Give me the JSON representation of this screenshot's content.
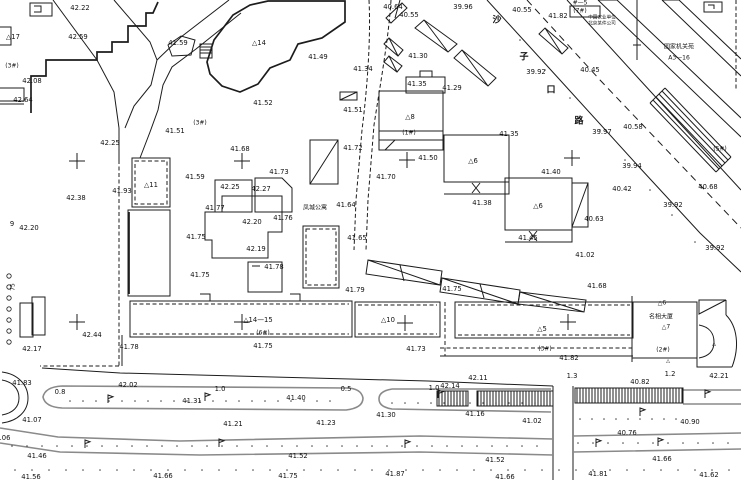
{
  "map": {
    "type": "cadastral-survey-plan",
    "background": "#ffffff",
    "ink_color": "#1c1c1c",
    "curb_color": "#8a8a8a",
    "street_name": "沙子口路",
    "compound_names": [
      "凤城公寓",
      "名相大厦",
      "国家机关苑",
      "中国农业单位",
      "北京某件公司"
    ],
    "street_chars": [
      {
        "x": 497,
        "y": 20,
        "t": "沙"
      },
      {
        "x": 524,
        "y": 57,
        "t": "子"
      },
      {
        "x": 551,
        "y": 90,
        "t": "口"
      },
      {
        "x": 579,
        "y": 121,
        "t": "路"
      }
    ],
    "labels": [
      {
        "x": 80,
        "y": 8,
        "t": "42.22"
      },
      {
        "x": 78,
        "y": 37,
        "t": "42.59"
      },
      {
        "x": 13,
        "y": 37,
        "t": "△17"
      },
      {
        "x": 12,
        "y": 66,
        "t": "(3#)",
        "fs": 6
      },
      {
        "x": 32,
        "y": 81,
        "t": "42.08"
      },
      {
        "x": 23,
        "y": 100,
        "t": "42.64"
      },
      {
        "x": 178,
        "y": 43,
        "t": "41.59"
      },
      {
        "x": 259,
        "y": 43,
        "t": "△14"
      },
      {
        "x": 263,
        "y": 103,
        "t": "41.52"
      },
      {
        "x": 200,
        "y": 123,
        "t": "(3#)",
        "fs": 6
      },
      {
        "x": 175,
        "y": 131,
        "t": "41.51"
      },
      {
        "x": 318,
        "y": 57,
        "t": "41.49"
      },
      {
        "x": 353,
        "y": 110,
        "t": "41.51"
      },
      {
        "x": 110,
        "y": 143,
        "t": "42.25"
      },
      {
        "x": 76,
        "y": 198,
        "t": "42.38"
      },
      {
        "x": 122,
        "y": 191,
        "t": "41.93"
      },
      {
        "x": 151,
        "y": 185,
        "t": "△11"
      },
      {
        "x": 12,
        "y": 224,
        "t": "9"
      },
      {
        "x": 29,
        "y": 228,
        "t": "42.20"
      },
      {
        "x": 13,
        "y": 287,
        "t": "75",
        "rot": -90,
        "fs": 6
      },
      {
        "x": 240,
        "y": 149,
        "t": "41.68"
      },
      {
        "x": 279,
        "y": 172,
        "t": "41.73"
      },
      {
        "x": 195,
        "y": 177,
        "t": "41.59"
      },
      {
        "x": 230,
        "y": 187,
        "t": "42.25"
      },
      {
        "x": 261,
        "y": 189,
        "t": "42.27"
      },
      {
        "x": 215,
        "y": 208,
        "t": "41.77"
      },
      {
        "x": 252,
        "y": 222,
        "t": "42.20"
      },
      {
        "x": 283,
        "y": 218,
        "t": "41.76"
      },
      {
        "x": 196,
        "y": 237,
        "t": "41.75"
      },
      {
        "x": 256,
        "y": 249,
        "t": "42.19"
      },
      {
        "x": 274,
        "y": 267,
        "t": "41.78"
      },
      {
        "x": 200,
        "y": 275,
        "t": "41.75"
      },
      {
        "x": 315,
        "y": 208,
        "t": "凤城公寓",
        "fs": 6
      },
      {
        "x": 346,
        "y": 205,
        "t": "41.64"
      },
      {
        "x": 357,
        "y": 238,
        "t": "41.65"
      },
      {
        "x": 353,
        "y": 148,
        "t": "41.72"
      },
      {
        "x": 393,
        "y": 7,
        "t": "40.64"
      },
      {
        "x": 409,
        "y": 15,
        "t": "40.55"
      },
      {
        "x": 463,
        "y": 7,
        "t": "39.96"
      },
      {
        "x": 418,
        "y": 56,
        "t": "41.30"
      },
      {
        "x": 363,
        "y": 69,
        "t": "41.34"
      },
      {
        "x": 417,
        "y": 84,
        "t": "41.35"
      },
      {
        "x": 452,
        "y": 88,
        "t": "41.29"
      },
      {
        "x": 410,
        "y": 117,
        "t": "△8"
      },
      {
        "x": 409,
        "y": 133,
        "t": "(1#)",
        "fs": 6
      },
      {
        "x": 428,
        "y": 158,
        "t": "41.50"
      },
      {
        "x": 386,
        "y": 177,
        "t": "41.70"
      },
      {
        "x": 473,
        "y": 161,
        "t": "△6"
      },
      {
        "x": 482,
        "y": 203,
        "t": "41.38"
      },
      {
        "x": 538,
        "y": 206,
        "t": "△6"
      },
      {
        "x": 528,
        "y": 238,
        "t": "41.45"
      },
      {
        "x": 551,
        "y": 172,
        "t": "41.40"
      },
      {
        "x": 509,
        "y": 134,
        "t": "41.35"
      },
      {
        "x": 522,
        "y": 10,
        "t": "40.55"
      },
      {
        "x": 558,
        "y": 16,
        "t": "41.82"
      },
      {
        "x": 580,
        "y": 3,
        "t": "#—5",
        "fs": 6
      },
      {
        "x": 580,
        "y": 11,
        "t": "(7#)",
        "fs": 6
      },
      {
        "x": 602,
        "y": 17,
        "t": "中国农业单位",
        "fs": 4.6
      },
      {
        "x": 602,
        "y": 23,
        "t": "北京某件公司",
        "fs": 4.6
      },
      {
        "x": 679,
        "y": 47,
        "t": "国家机关苑",
        "fs": 6
      },
      {
        "x": 679,
        "y": 58,
        "t": "A3—16",
        "fs": 6
      },
      {
        "x": 536,
        "y": 72,
        "t": "39.92"
      },
      {
        "x": 590,
        "y": 70,
        "t": "40.45"
      },
      {
        "x": 602,
        "y": 132,
        "t": "39.97"
      },
      {
        "x": 633,
        "y": 127,
        "t": "40.58"
      },
      {
        "x": 632,
        "y": 166,
        "t": "39.94"
      },
      {
        "x": 622,
        "y": 189,
        "t": "40.42"
      },
      {
        "x": 673,
        "y": 205,
        "t": "39.92"
      },
      {
        "x": 715,
        "y": 248,
        "t": "39.92"
      },
      {
        "x": 594,
        "y": 219,
        "t": "40.63"
      },
      {
        "x": 708,
        "y": 187,
        "t": "40.68"
      },
      {
        "x": 720,
        "y": 149,
        "t": "(5#)",
        "fs": 6
      },
      {
        "x": 585,
        "y": 255,
        "t": "41.02"
      },
      {
        "x": 597,
        "y": 286,
        "t": "41.68"
      },
      {
        "x": 92,
        "y": 335,
        "t": "42.44"
      },
      {
        "x": 32,
        "y": 349,
        "t": "42.17"
      },
      {
        "x": 129,
        "y": 347,
        "t": "41.78"
      },
      {
        "x": 22,
        "y": 383,
        "t": "41.83"
      },
      {
        "x": 128,
        "y": 385,
        "t": "42.02"
      },
      {
        "x": 60,
        "y": 392,
        "t": "0.8"
      },
      {
        "x": 220,
        "y": 389,
        "t": "1.0"
      },
      {
        "x": 258,
        "y": 320,
        "t": "△14—15"
      },
      {
        "x": 263,
        "y": 333,
        "t": "(6#)",
        "fs": 6
      },
      {
        "x": 263,
        "y": 346,
        "t": "41.75"
      },
      {
        "x": 355,
        "y": 290,
        "t": "41.79"
      },
      {
        "x": 452,
        "y": 289,
        "t": "41.75"
      },
      {
        "x": 388,
        "y": 320,
        "t": "△10"
      },
      {
        "x": 416,
        "y": 349,
        "t": "41.73"
      },
      {
        "x": 346,
        "y": 389,
        "t": "0.5"
      },
      {
        "x": 434,
        "y": 388,
        "t": "1.0"
      },
      {
        "x": 450,
        "y": 386,
        "t": "42.14"
      },
      {
        "x": 478,
        "y": 378,
        "t": "42.11"
      },
      {
        "x": 542,
        "y": 329,
        "t": "△5"
      },
      {
        "x": 545,
        "y": 349,
        "t": "(3#)",
        "fs": 6
      },
      {
        "x": 569,
        "y": 358,
        "t": "41.82"
      },
      {
        "x": 572,
        "y": 376,
        "t": "1.3"
      },
      {
        "x": 670,
        "y": 374,
        "t": "1.2"
      },
      {
        "x": 719,
        "y": 376,
        "t": "42.21"
      },
      {
        "x": 640,
        "y": 382,
        "t": "40.82"
      },
      {
        "x": 662,
        "y": 303,
        "t": "△6",
        "fs": 6
      },
      {
        "x": 661,
        "y": 317,
        "t": "名相大厦",
        "fs": 6
      },
      {
        "x": 666,
        "y": 327,
        "t": "△7",
        "fs": 6
      },
      {
        "x": 663,
        "y": 350,
        "t": "(2#)",
        "fs": 6
      },
      {
        "x": 668,
        "y": 361,
        "t": "△",
        "fs": 5
      },
      {
        "x": 714,
        "y": 344,
        "t": "△",
        "fs": 5
      },
      {
        "x": 192,
        "y": 401,
        "t": "41.31"
      },
      {
        "x": 296,
        "y": 398,
        "t": "41.40"
      },
      {
        "x": 32,
        "y": 420,
        "t": "41.07"
      },
      {
        "x": 233,
        "y": 424,
        "t": "41.21"
      },
      {
        "x": 326,
        "y": 423,
        "t": "41.23"
      },
      {
        "x": 386,
        "y": 415,
        "t": "41.30"
      },
      {
        "x": 475,
        "y": 414,
        "t": "41.16"
      },
      {
        "x": 532,
        "y": 421,
        "t": "41.02"
      },
      {
        "x": 627,
        "y": 433,
        "t": "40.76"
      },
      {
        "x": 690,
        "y": 422,
        "t": "40.90"
      },
      {
        "x": 5,
        "y": 438,
        "t": ".06"
      },
      {
        "x": 37,
        "y": 456,
        "t": "41.46"
      },
      {
        "x": 298,
        "y": 456,
        "t": "41.52"
      },
      {
        "x": 495,
        "y": 460,
        "t": "41.52"
      },
      {
        "x": 662,
        "y": 459,
        "t": "41.66"
      },
      {
        "x": 598,
        "y": 474,
        "t": "41.81"
      },
      {
        "x": 31,
        "y": 477,
        "t": "41.56"
      },
      {
        "x": 163,
        "y": 476,
        "t": "41.66"
      },
      {
        "x": 288,
        "y": 476,
        "t": "41.75"
      },
      {
        "x": 395,
        "y": 474,
        "t": "41.87"
      },
      {
        "x": 505,
        "y": 477,
        "t": "41.66"
      },
      {
        "x": 709,
        "y": 475,
        "t": "41.62"
      }
    ],
    "survey_crosses": [
      [
        77,
        161
      ],
      [
        242,
        161
      ],
      [
        407,
        160
      ],
      [
        572,
        158
      ],
      [
        77,
        322
      ],
      [
        242,
        322
      ],
      [
        405,
        323
      ],
      [
        568,
        322
      ]
    ],
    "lamp_flags": [
      [
        108,
        403
      ],
      [
        205,
        401
      ],
      [
        438,
        398
      ],
      [
        85,
        448
      ],
      [
        219,
        447
      ],
      [
        405,
        448
      ],
      [
        658,
        446
      ],
      [
        705,
        398
      ],
      [
        596,
        447
      ],
      [
        640,
        416
      ]
    ],
    "fence_circles": {
      "x": 9,
      "y0": 276,
      "y1": 344,
      "step": 11,
      "r": 2.2
    },
    "dot_rows": [
      {
        "y": 401,
        "x0": 70,
        "x1": 340,
        "step": 13
      },
      {
        "y": 403,
        "x0": 392,
        "x1": 545,
        "step": 13
      },
      {
        "y": 446,
        "x0": 12,
        "x1": 540,
        "step": 15
      },
      {
        "y": 443,
        "x0": 578,
        "x1": 738,
        "step": 15
      },
      {
        "y": 470,
        "x0": 15,
        "x1": 735,
        "step": 17
      },
      {
        "y": 419,
        "x0": 580,
        "x1": 680,
        "step": 12
      }
    ],
    "road_dots": [
      [
        520,
        40
      ],
      [
        545,
        70
      ],
      [
        570,
        98
      ],
      [
        600,
        130
      ],
      [
        625,
        160
      ],
      [
        650,
        190
      ],
      [
        672,
        215
      ],
      [
        695,
        242
      ]
    ]
  }
}
